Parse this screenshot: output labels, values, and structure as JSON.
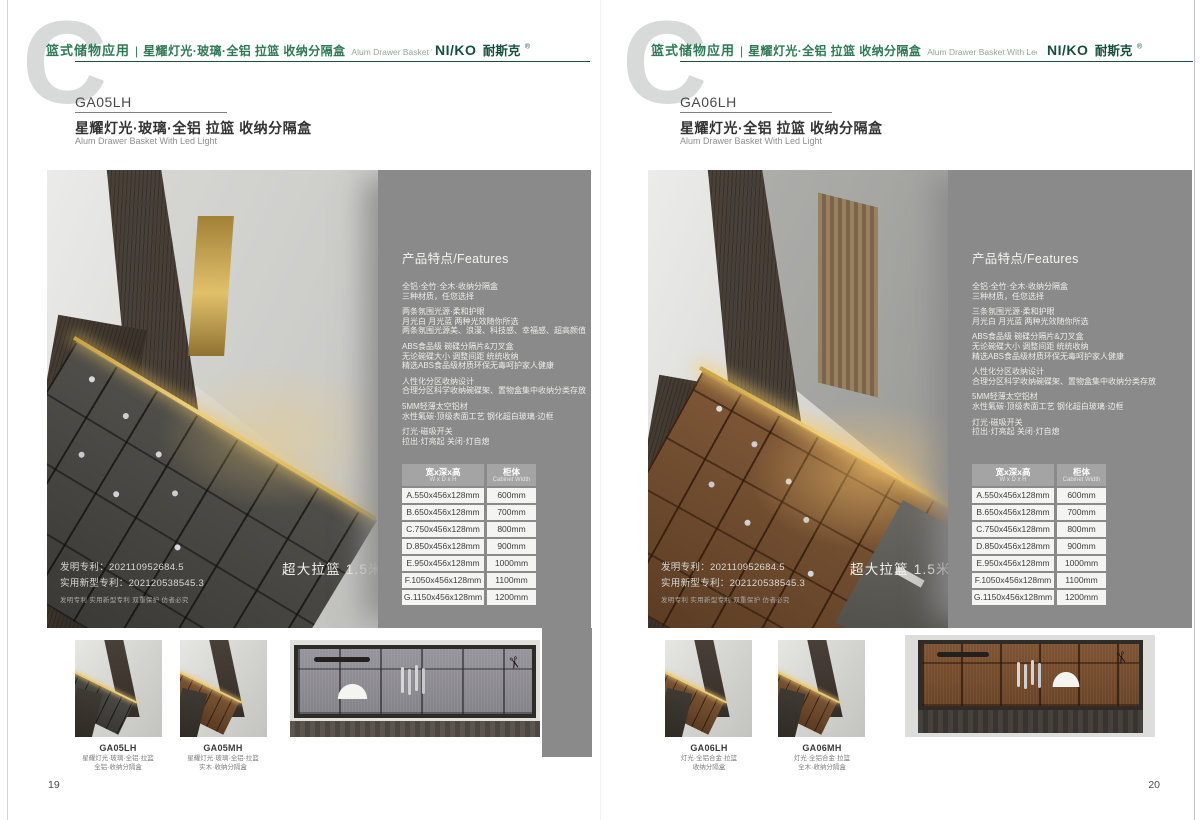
{
  "colors": {
    "brand_green": "#2e7a55",
    "logo_green": "#17503c",
    "panel_gray": "#8a8a8a",
    "led_gold": "#e6c468"
  },
  "icons": {
    "scissors": "✂"
  },
  "pages": [
    {
      "page_number": "19",
      "header": {
        "watermark": "C",
        "category": "篮式储物应用",
        "divider": "|",
        "product_line": "星耀灯光·玻璃·全铝 拉篮 收纳分隔盒",
        "product_line_en": "Alum Drawer Basket With Led Light",
        "brand": "NI/KO",
        "brand_cn": "耐斯克",
        "brand_reg": "®"
      },
      "product": {
        "model": "GA05LH",
        "title": "星耀灯光·玻璃·全铝 拉篮 收纳分隔盒",
        "subtitle": "Alum Drawer Basket With Led Light"
      },
      "features": {
        "heading": "产品特点/Features",
        "groups": [
          [
            "全铝·全竹·全木·收纳分隔盒",
            "三种材质，任您选择"
          ],
          [
            "两条氛围光源·柔和护眼",
            "月光白 月光蓝 两种光效随你所选",
            "两条氛围光源美、浪漫、科技感、幸福感、超高颜值"
          ],
          [
            "ABS食品级 碗碟分隔片&刀叉盒",
            "无论碗碟大小 调整间距 统统收纳",
            "精选ABS食品级材质环保无毒呵护家人健康"
          ],
          [
            "人性化分区收纳设计",
            "合理分区科学收纳碗碟架、置物盒集中收纳分类存放"
          ],
          [
            "5MM轻薄太空铝材",
            "水性氟碳·顶级表面工艺 钢化超白玻璃·边框"
          ],
          [
            "灯光·磁吸开关",
            "拉出·灯亮起 关闭·灯自熄"
          ]
        ]
      },
      "patent": {
        "line1": "发明专利：202110952684.5",
        "line2": "实用新型专利：202120538545.3",
        "line3": "发明专利 实用新型专利 双重保护 仿者必究"
      },
      "banner": "超大拉篮 1.5米 可定制",
      "size_table": {
        "col1_header": "宽x深x高",
        "col1_sub": "W x D x H",
        "col2_header": "柜体",
        "col2_sub": "Cabinet Width",
        "rows": [
          {
            "size": "A.550x456x128mm",
            "cabinet": "600mm"
          },
          {
            "size": "B.650x456x128mm",
            "cabinet": "700mm"
          },
          {
            "size": "C.750x456x128mm",
            "cabinet": "800mm"
          },
          {
            "size": "D.850x456x128mm",
            "cabinet": "900mm"
          },
          {
            "size": "E.950x456x128mm",
            "cabinet": "1000mm"
          },
          {
            "size": "F.1050x456x128mm",
            "cabinet": "1100mm"
          },
          {
            "size": "G.1150x456x128mm",
            "cabinet": "1200mm"
          }
        ]
      },
      "thumbnails": [
        {
          "model": "GA05LH",
          "line1": "星耀灯光·玻璃·全铝·拉篮",
          "line2": "全铝·收纳分隔盒"
        },
        {
          "model": "GA05MH",
          "line1": "星耀灯光·玻璃·全铝·拉篮",
          "line2": "实木·收纳分隔盒"
        }
      ]
    },
    {
      "page_number": "20",
      "header": {
        "watermark": "C",
        "category": "篮式储物应用",
        "divider": "|",
        "product_line": "星耀灯光·全铝 拉篮 收纳分隔盒",
        "product_line_en": "Alum Drawer Basket With Led Light",
        "brand": "NI/KO",
        "brand_cn": "耐斯克",
        "brand_reg": "®"
      },
      "product": {
        "model": "GA06LH",
        "title": "星耀灯光·全铝 拉篮 收纳分隔盒",
        "subtitle": "Alum Drawer Basket With Led Light"
      },
      "features": {
        "heading": "产品特点/Features",
        "groups": [
          [
            "全铝·全竹·全木·收纳分隔盒",
            "三种材质，任您选择"
          ],
          [
            "三条氛围光源·柔和护眼",
            "月光白 月光蓝 两种光效随你所选"
          ],
          [
            "ABS食品级 碗碟分隔片&刀叉盒",
            "无论碗碟大小 调整间距 统统收纳",
            "精选ABS食品级材质环保无毒呵护家人健康"
          ],
          [
            "人性化分区收纳设计",
            "合理分区科学收纳碗碟架、置物盒集中收纳分类存放"
          ],
          [
            "5MM轻薄太空铝材",
            "水性氟碳·顶级表面工艺 钢化超白玻璃·边框"
          ],
          [
            "灯光·磁吸开关",
            "拉出·灯亮起 关闭·灯自熄"
          ]
        ]
      },
      "patent": {
        "line1": "发明专利：202110952684.5",
        "line2": "实用新型专利：202120538545.3",
        "line3": "发明专利 实用新型专利 双重保护 仿者必究"
      },
      "banner": "超大拉篮 1.5米 可定制",
      "size_table": {
        "col1_header": "宽x深x高",
        "col1_sub": "W x D x H",
        "col2_header": "柜体",
        "col2_sub": "Cabinet Width",
        "rows": [
          {
            "size": "A.550x456x128mm",
            "cabinet": "600mm"
          },
          {
            "size": "B.650x456x128mm",
            "cabinet": "700mm"
          },
          {
            "size": "C.750x456x128mm",
            "cabinet": "800mm"
          },
          {
            "size": "D.850x456x128mm",
            "cabinet": "900mm"
          },
          {
            "size": "E.950x456x128mm",
            "cabinet": "1000mm"
          },
          {
            "size": "F.1050x456x128mm",
            "cabinet": "1100mm"
          },
          {
            "size": "G.1150x456x128mm",
            "cabinet": "1200mm"
          }
        ]
      },
      "thumbnails": [
        {
          "model": "GA06LH",
          "line1": "灯光·全铝合金·拉篮",
          "line2": "收纳分隔盒"
        },
        {
          "model": "GA06MH",
          "line1": "灯光·全铝合金·拉篮",
          "line2": "全木·收纳分隔盒"
        }
      ]
    }
  ]
}
